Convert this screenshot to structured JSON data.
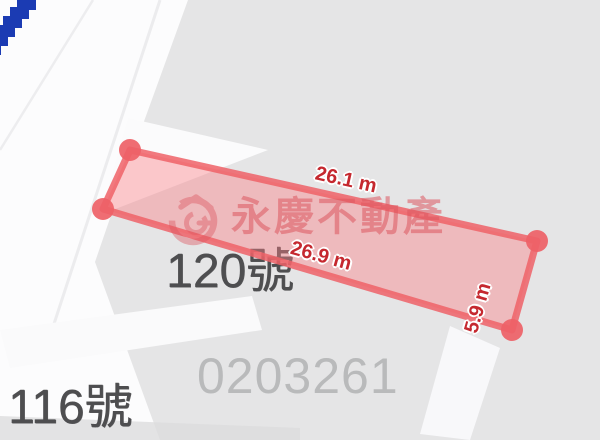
{
  "watermark": {
    "company": "永慶不動產",
    "ref_number": "0203261"
  },
  "parcel": {
    "measurements": {
      "top": "26.1 m",
      "bottom": "26.9 m",
      "right": "5.9 m"
    },
    "vertices_px": [
      [
        130,
        150
      ],
      [
        537,
        241
      ],
      [
        512,
        330
      ],
      [
        103,
        209
      ]
    ]
  },
  "map_labels": {
    "house_120": "120號",
    "house_116": "116號"
  },
  "colors": {
    "parcel_stroke": "#ee6167",
    "parcel_fill": "#fa7e85",
    "measurement_text": "#c5282f",
    "watermark_pink": "#dd5560",
    "address_label_gray": "#4e4e50",
    "ref_number_gray": "#b9babb",
    "boundary_blue": "#1b3bb3",
    "block_gray": "#e5e5e6",
    "road_white": "#fcfcfd"
  }
}
